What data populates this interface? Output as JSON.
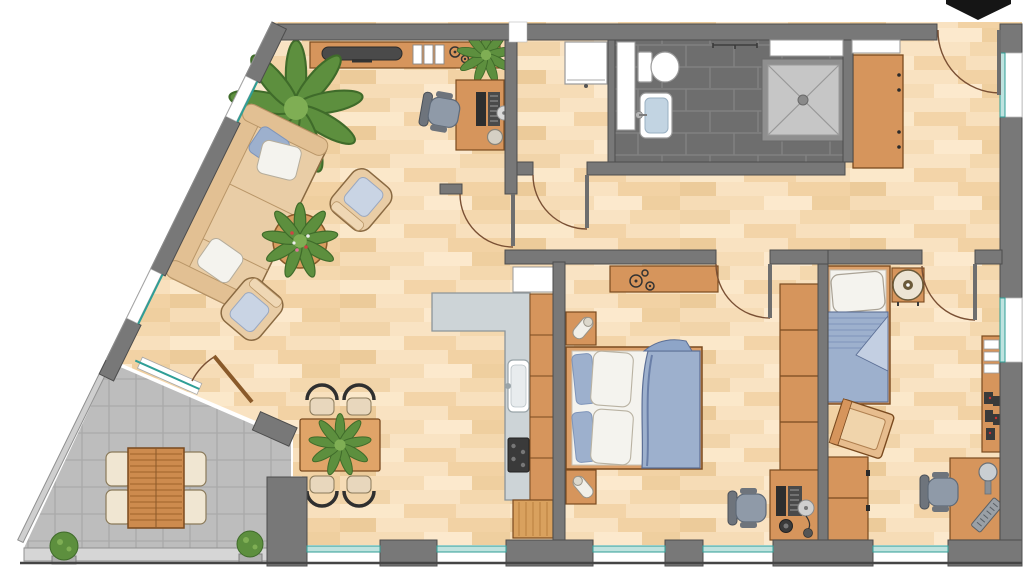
{
  "app": {
    "type": "floor-plan-illustration",
    "title": ""
  },
  "colors": {
    "wall": "#787878",
    "wall-outline": "#4d4d4d",
    "floor-base": "#f6dcb6",
    "counter": "#cdd4d7",
    "counter-edge": "#8b9499",
    "furniture-wood": "#d6955c",
    "furniture-wood-light": "#dca06a",
    "furniture-wood-dark": "#7a4a1f",
    "bath-tile": "#6e6e6e",
    "bath-grout": "#818181",
    "shower-tray": "#c6c6c6",
    "terrace-tile": "#bdbdbd",
    "terrace-grout": "#aaaaaa",
    "window-teal": "#2f9e96",
    "window-glass": "#bfe3df",
    "textile-blue": "#9db0cd",
    "textile-blue-dark": "#5c6f96",
    "textile-white": "#f4f3ee",
    "sofa-beige": "#e9cda6",
    "plant-green": "#5d8f3e",
    "plant-green-dark": "#3f6b2a",
    "appliance-dark": "#3a3a3a",
    "chair-gray": "#8f9aa8",
    "arrow-black": "#151515"
  },
  "compass": {
    "icon": "north-arrow",
    "position": "top-right"
  },
  "rooms": {
    "living_room": {
      "name": "living-room",
      "floor": "parquet",
      "furniture": [
        "sideboard",
        "tv",
        "magazine-files",
        "decor-rings",
        "sideboard-plant",
        "workstation-desk",
        "office-chair",
        "desk-lamp",
        "cd-disc",
        "large-potted-plant",
        "sofa",
        "sofa-cushions",
        "round-coffee-table",
        "coffee-table-plant",
        "armchair",
        "armchair",
        "dining-table",
        "dining-chair",
        "dining-chair",
        "dining-chair",
        "dining-chair",
        "dining-table-plant"
      ]
    },
    "open_kitchen": {
      "name": "open-kitchen",
      "floor": "parquet",
      "furniture": [
        "l-shaped-counter",
        "kitchen-sink",
        "cooktop",
        "tall-fridge-cabinet",
        "cabinet-column",
        "base-cabinet"
      ]
    },
    "utility_room": {
      "name": "utility-room",
      "floor": "parquet",
      "furniture": [
        "washing-machine"
      ]
    },
    "bathroom": {
      "name": "bathroom",
      "floor": "dark-tile",
      "furniture": [
        "toilet",
        "washbasin",
        "shower",
        "towel-rail",
        "tall-white-cabinet",
        "high-window",
        "high-window"
      ]
    },
    "hallway": {
      "name": "hallway",
      "floor": "parquet",
      "furniture": [
        "wardrobe",
        "entrance-door"
      ]
    },
    "master_bedroom": {
      "name": "master-bedroom",
      "floor": "parquet",
      "furniture": [
        "double-bed",
        "pillows",
        "duvet",
        "nightstand",
        "nightstand",
        "table-lamp",
        "table-lamp",
        "dresser",
        "decor-rings",
        "wardrobe-column",
        "desk",
        "office-chair",
        "computer",
        "speaker",
        "cd-disc"
      ]
    },
    "second_bedroom": {
      "name": "second-bedroom",
      "floor": "parquet",
      "furniture": [
        "single-bed",
        "pillow",
        "striped-duvet",
        "round-side-table",
        "side-chair",
        "cabinet-stack",
        "wall-shelf",
        "books",
        "toy-figures",
        "desk",
        "office-chair",
        "desk-lamp",
        "keyboard"
      ]
    },
    "terrace": {
      "name": "terrace",
      "floor": "stone-tile",
      "furniture": [
        "slatted-wooden-table",
        "garden-chair",
        "garden-chair",
        "garden-chair",
        "garden-chair",
        "planter-bush",
        "planter-bush",
        "parapet"
      ]
    }
  },
  "doors": [
    "entrance-door",
    "living-room-door",
    "utility-room-door",
    "master-bedroom-door",
    "second-bedroom-door",
    "terrace-door"
  ],
  "windows": {
    "diagonal_facade": 2,
    "bottom_facade": 5,
    "right_facade": 2,
    "bathroom_top": 2
  }
}
